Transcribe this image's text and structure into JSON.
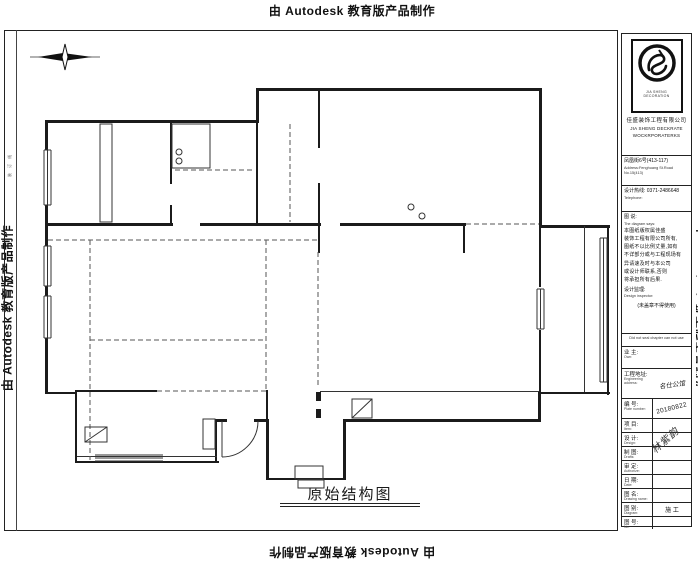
{
  "watermark": {
    "text": "由 Autodesk 教育版产品制作"
  },
  "margin": {
    "binding_note": "装 订 线"
  },
  "title_label": {
    "text": "原始结构图"
  },
  "title_block": {
    "logo": {
      "caption": "JIA SHENG DECORATION",
      "company_cn": "佳盛装饰工程有限公司",
      "company_en_1": "JIA SHENG DECKRATE",
      "company_en_2": "WOCKRPORATERKS"
    },
    "address_cn": "凤凰街6号(413-117)",
    "address_en": "Address:Fenghuang St.Road No.15(413)",
    "phone_cn": "设计热线: 0371-2486648",
    "phone_en": "Telephone:",
    "diagram_says": {
      "label_cn": "图 说:",
      "label_en": "The diagram says:",
      "lines": [
        "本图纸版权属佳盛",
        "装饰工程有限公司所有,",
        "图纸不以比例丈量,如有",
        "不详部分或与工程现场有",
        "异请速及时与本公司",
        "或设计师联系,否则",
        "将承担所有后果."
      ],
      "supervisor_cn": "设计监理:",
      "supervisor_en": "Design inspector:",
      "seal_note_cn": "(未盖章不得使用)",
      "seal_note_en": "Did not seal chapter can not use"
    },
    "rows": [
      {
        "label_cn": "业 主:",
        "label_en": "Own:",
        "value": ""
      },
      {
        "label_cn": "工程地址:",
        "label_en": "Engineering address:",
        "value": "名仕公馆"
      },
      {
        "label_cn": "编 号:",
        "label_en": "Plate number:",
        "value": "20180822"
      },
      {
        "label_cn": "项 目:",
        "label_en": "Item:",
        "value": ""
      },
      {
        "label_cn": "设 计:",
        "label_en": "Design:",
        "value": ""
      },
      {
        "label_cn": "制 图:",
        "label_en": "Drafts:",
        "value": ""
      },
      {
        "label_cn": "审 定:",
        "label_en": "Authorize:",
        "value": ""
      },
      {
        "label_cn": "日 期:",
        "label_en": "Date:",
        "value": ""
      },
      {
        "label_cn": "图 名:",
        "label_en": "Drawing name:",
        "value": ""
      },
      {
        "label_cn": "图 别:",
        "label_en": "Diagram:",
        "value": "施 工"
      },
      {
        "label_cn": "图 号:",
        "label_en": "No:",
        "value": ""
      }
    ],
    "signature": "林紫韵"
  },
  "colors": {
    "line": "#1b1b1b",
    "thin": "#333333",
    "dashed": "#555555"
  },
  "plan": {
    "walls": [
      [
        45,
        120,
        213,
        3
      ],
      [
        256,
        88,
        3,
        35
      ],
      [
        256,
        88,
        286,
        3
      ],
      [
        539,
        88,
        3,
        140
      ],
      [
        539,
        225,
        71,
        3
      ],
      [
        607,
        225,
        2,
        170
      ],
      [
        539,
        392,
        71,
        2
      ],
      [
        538,
        392,
        3,
        30
      ],
      [
        344,
        419,
        196,
        3
      ],
      [
        266,
        419,
        3,
        61
      ],
      [
        266,
        478,
        80,
        2
      ],
      [
        343,
        419,
        3,
        61
      ],
      [
        45,
        120,
        3,
        274
      ],
      [
        45,
        392,
        32,
        2
      ],
      [
        75,
        392,
        2,
        71
      ],
      [
        75,
        461,
        144,
        2
      ],
      [
        215,
        419,
        2,
        44
      ],
      [
        215,
        419,
        12,
        3
      ],
      [
        254,
        419,
        14,
        3
      ],
      [
        45,
        223,
        128,
        3
      ],
      [
        200,
        223,
        121,
        3
      ],
      [
        340,
        223,
        126,
        3
      ],
      [
        170,
        122,
        2,
        62
      ],
      [
        170,
        205,
        2,
        20
      ],
      [
        318,
        90,
        2,
        58
      ],
      [
        318,
        183,
        2,
        42
      ],
      [
        256,
        122,
        2,
        103
      ],
      [
        318,
        225,
        2,
        28
      ],
      [
        463,
        225,
        2,
        28
      ],
      [
        539,
        225,
        2,
        62
      ],
      [
        539,
        330,
        2,
        64
      ],
      [
        266,
        390,
        2,
        30
      ],
      [
        75,
        390,
        82,
        2
      ],
      [
        316,
        392,
        5,
        9
      ],
      [
        316,
        409,
        5,
        9
      ]
    ],
    "thin": [
      [
        100,
        124,
        12,
        98
      ],
      [
        172,
        124,
        38,
        44
      ],
      [
        203,
        419,
        12,
        30
      ],
      [
        295,
        466,
        28,
        13
      ],
      [
        298,
        480,
        26,
        8
      ],
      [
        584,
        226,
        1,
        166
      ],
      [
        320,
        391,
        219,
        1
      ],
      [
        77,
        456,
        140,
        1
      ]
    ],
    "dashed": [
      [
        48,
        240,
        318,
        240
      ],
      [
        90,
        240,
        90,
        460
      ],
      [
        90,
        340,
        266,
        340
      ],
      [
        266,
        240,
        266,
        390
      ],
      [
        318,
        252,
        318,
        388
      ],
      [
        157,
        391,
        266,
        391
      ],
      [
        466,
        224,
        539,
        224
      ],
      [
        290,
        124,
        290,
        222
      ],
      [
        175,
        170,
        254,
        170
      ]
    ],
    "windows_v": [
      [
        44,
        150,
        55
      ],
      [
        44,
        246,
        40
      ],
      [
        44,
        296,
        42
      ],
      [
        600,
        238,
        144
      ],
      [
        537,
        289,
        40
      ]
    ],
    "windows_h": [
      [
        95,
        455,
        68
      ]
    ],
    "circles": [
      [
        179,
        152,
        3
      ],
      [
        179,
        161,
        3
      ],
      [
        411,
        207,
        3
      ],
      [
        422,
        216,
        3
      ]
    ],
    "hatch": [
      [
        85,
        427,
        22,
        15
      ],
      [
        352,
        399,
        20,
        19
      ]
    ],
    "door": {
      "leaf": [
        222,
        421,
        222,
        457
      ],
      "arc": "M 222 457 A 36 36 0 0 0 258 421"
    },
    "compass": {
      "axis": [
        30,
        57,
        100,
        57
      ],
      "h_points": "38,57 63,53 92,57 63,61",
      "v_points": "65,44 68,57 65,70 62,57"
    }
  }
}
